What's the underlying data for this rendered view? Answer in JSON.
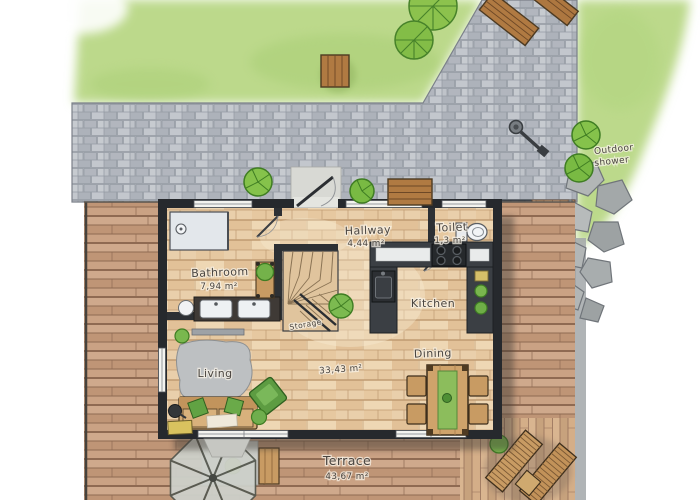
{
  "title": "Watercolor house floor plan with garden and terrace",
  "rooms": {
    "bathroom": {
      "name": "Bathroom",
      "area": "7,94 m²"
    },
    "hallway": {
      "name": "Hallway",
      "area": "4,44 m²"
    },
    "toilet": {
      "name": "Toilet",
      "area": "1,3 m²"
    },
    "kitchen": {
      "name": "Kitchen"
    },
    "dining": {
      "name": "Dining"
    },
    "living": {
      "name": "Living"
    },
    "storage": {
      "name": "Storage"
    },
    "open_space": {
      "area": "33,43 m²"
    },
    "terrace": {
      "name": "Terrace",
      "area": "43,67 m²"
    }
  },
  "outdoor": {
    "shower": {
      "line1": "Outdoor",
      "line2": "shower"
    }
  },
  "colors": {
    "grass": "#bcd98b",
    "pavers": "#b9bdc4",
    "deck": "#c79e83",
    "wall": "#26292d",
    "floor": "#e9cfab",
    "accent_green": "#7ab64e",
    "label_ink": "#4a4540"
  }
}
